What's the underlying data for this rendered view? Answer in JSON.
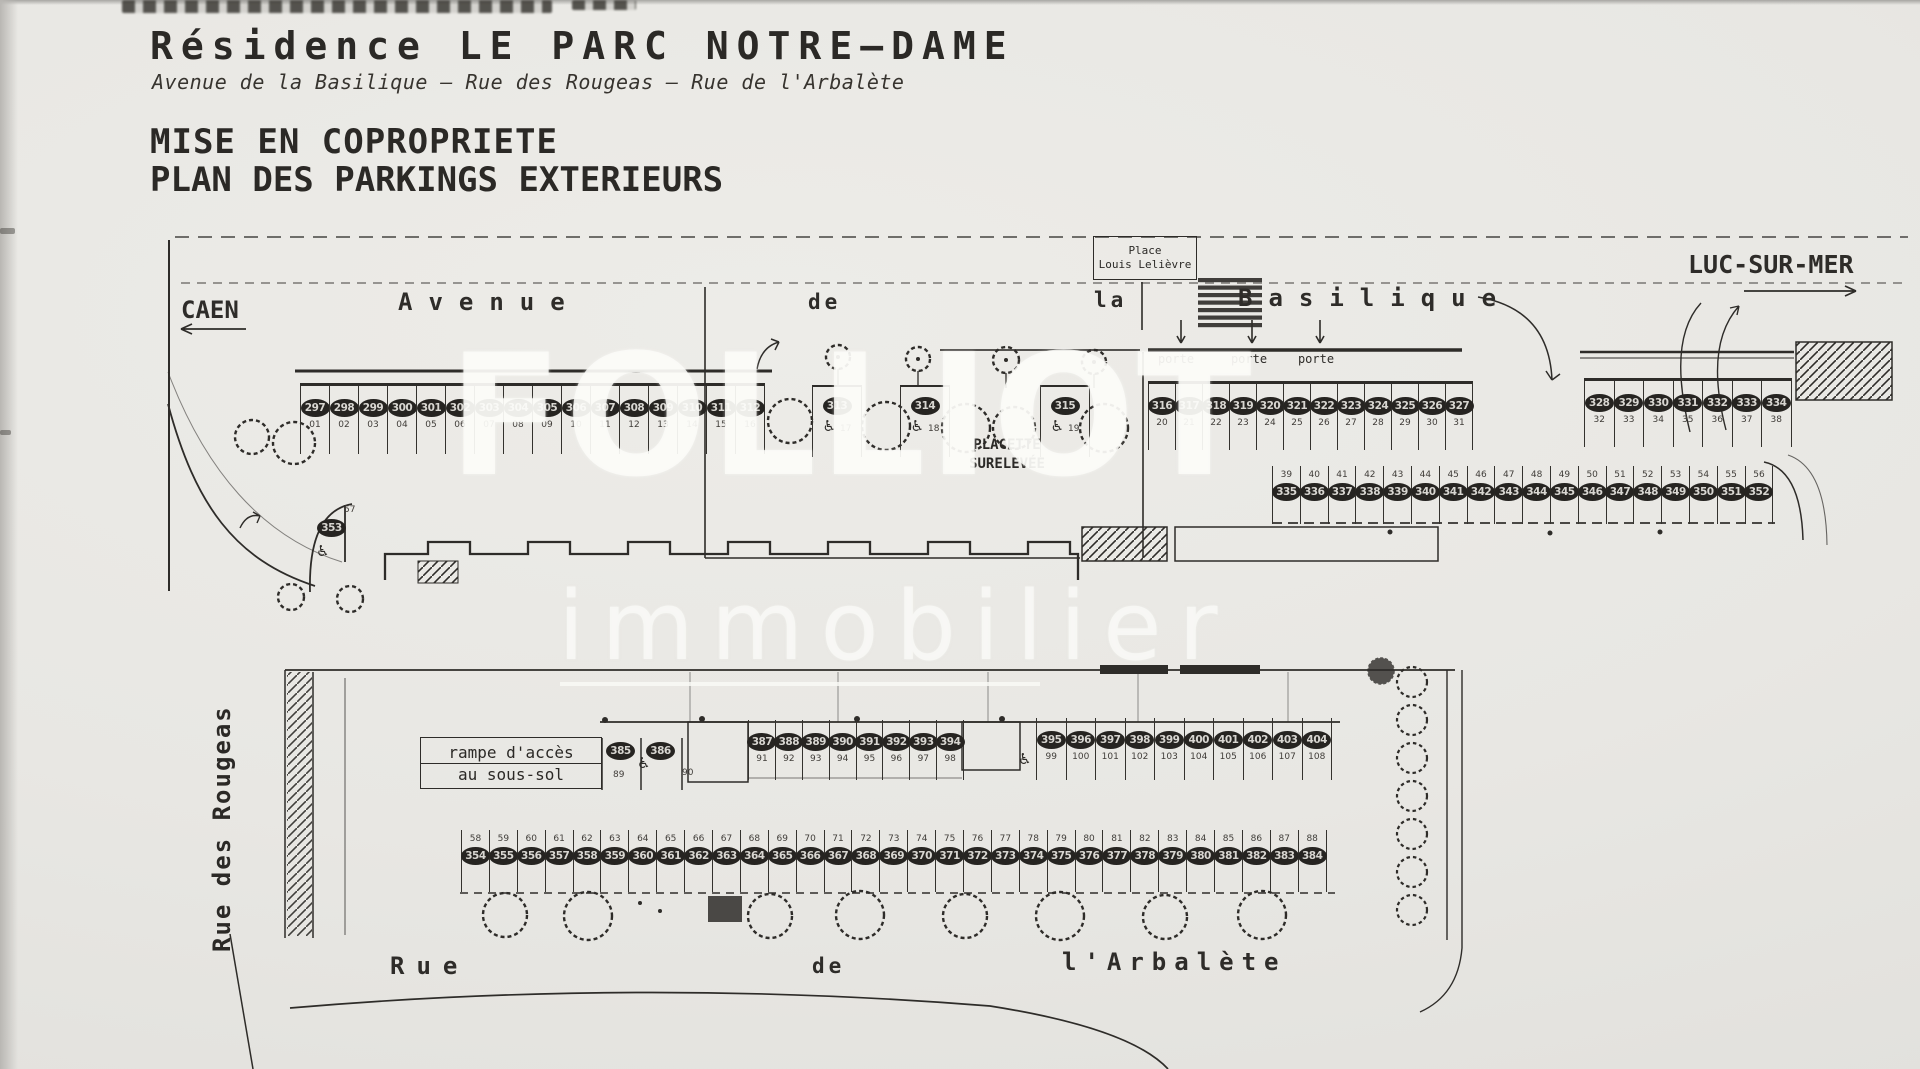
{
  "header": {
    "title": "Résidence LE PARC NOTRE–DAME",
    "subtitle": "Avenue de la Basilique – Rue des Rougeas – Rue de l'Arbalète",
    "heading_line1": "MISE EN COPROPRIETE",
    "heading_line2": "PLAN DES PARKINGS EXTERIEURS"
  },
  "watermark": {
    "line1": "FOLLIOT",
    "line2": "immobilier"
  },
  "symbols": {
    "wheelchair": "♿"
  },
  "colors": {
    "ink": "#2e2c29",
    "paper": "#e8e7e3",
    "watermark": "#fafaf7",
    "chip_fill": "#262421"
  },
  "upper": {
    "labels": {
      "caen": "CAEN",
      "luc_sur_mer": "LUC-SUR-MER",
      "avenue": "Avenue",
      "de": "de",
      "la": "la",
      "basilique": "Basilique",
      "place_line1": "Place",
      "place_line2": "Louis Lelièvre",
      "placette_line1": "PLACETTE",
      "placette_line2": "SURELEVÉE",
      "porte": "porte"
    },
    "row1_left": [
      {
        "n": "297",
        "s": "01"
      },
      {
        "n": "298",
        "s": "02"
      },
      {
        "n": "299",
        "s": "03"
      },
      {
        "n": "300",
        "s": "04"
      },
      {
        "n": "301",
        "s": "05"
      },
      {
        "n": "302",
        "s": "06"
      },
      {
        "n": "303",
        "s": "07"
      },
      {
        "n": "304",
        "s": "08"
      },
      {
        "n": "305",
        "s": "09"
      },
      {
        "n": "306",
        "s": "10"
      },
      {
        "n": "307",
        "s": "11"
      },
      {
        "n": "308",
        "s": "12"
      },
      {
        "n": "309",
        "s": "13"
      },
      {
        "n": "310",
        "s": "14"
      },
      {
        "n": "311",
        "s": "15"
      },
      {
        "n": "312",
        "s": "16"
      }
    ],
    "mid": [
      {
        "n": "313",
        "s": "17"
      },
      {
        "n": "314",
        "s": "18"
      },
      {
        "n": "315",
        "s": "19"
      }
    ],
    "row1_right": [
      {
        "n": "316",
        "s": "20"
      },
      {
        "n": "317",
        "s": "21"
      },
      {
        "n": "318",
        "s": "22"
      },
      {
        "n": "319",
        "s": "23"
      },
      {
        "n": "320",
        "s": "24"
      },
      {
        "n": "321",
        "s": "25"
      },
      {
        "n": "322",
        "s": "26"
      },
      {
        "n": "323",
        "s": "27"
      },
      {
        "n": "324",
        "s": "28"
      },
      {
        "n": "325",
        "s": "29"
      },
      {
        "n": "326",
        "s": "30"
      },
      {
        "n": "327",
        "s": "31"
      }
    ],
    "row1_far": [
      {
        "n": "328",
        "s": "32"
      },
      {
        "n": "329",
        "s": "33"
      },
      {
        "n": "330",
        "s": "34"
      },
      {
        "n": "331",
        "s": "35"
      },
      {
        "n": "332",
        "s": "36"
      },
      {
        "n": "333",
        "s": "37"
      },
      {
        "n": "334",
        "s": "38"
      }
    ],
    "row2": [
      {
        "n": "335",
        "s": "39"
      },
      {
        "n": "336",
        "s": "40"
      },
      {
        "n": "337",
        "s": "41"
      },
      {
        "n": "338",
        "s": "42"
      },
      {
        "n": "339",
        "s": "43"
      },
      {
        "n": "340",
        "s": "44"
      },
      {
        "n": "341",
        "s": "45"
      },
      {
        "n": "342",
        "s": "46"
      },
      {
        "n": "343",
        "s": "47"
      },
      {
        "n": "344",
        "s": "48"
      },
      {
        "n": "345",
        "s": "49"
      },
      {
        "n": "346",
        "s": "50"
      },
      {
        "n": "347",
        "s": "51"
      },
      {
        "n": "348",
        "s": "52"
      },
      {
        "n": "349",
        "s": "53"
      },
      {
        "n": "350",
        "s": "54"
      },
      {
        "n": "351",
        "s": "55"
      },
      {
        "n": "352",
        "s": "56"
      }
    ],
    "s353": {
      "n": "353",
      "s": "57"
    }
  },
  "lower": {
    "labels": {
      "rue_des_rougeas": "Rue des Rougeas",
      "rampe_line1": "rampe d'accès",
      "rampe_line2": "au sous-sol",
      "rue": "Rue",
      "de": "de",
      "arbalete": "l'Arbalète"
    },
    "s385": {
      "n": "385",
      "s": "89"
    },
    "s386": {
      "n": "386",
      "s": "90"
    },
    "row1_mid": [
      {
        "n": "387",
        "s": "91"
      },
      {
        "n": "388",
        "s": "92"
      },
      {
        "n": "389",
        "s": "93"
      },
      {
        "n": "390",
        "s": "94"
      },
      {
        "n": "391",
        "s": "95"
      },
      {
        "n": "392",
        "s": "96"
      },
      {
        "n": "393",
        "s": "97"
      },
      {
        "n": "394",
        "s": "98"
      }
    ],
    "row1_right": [
      {
        "n": "395",
        "s": "99"
      },
      {
        "n": "396",
        "s": "100"
      },
      {
        "n": "397",
        "s": "101"
      },
      {
        "n": "398",
        "s": "102"
      },
      {
        "n": "399",
        "s": "103"
      },
      {
        "n": "400",
        "s": "104"
      },
      {
        "n": "401",
        "s": "105"
      },
      {
        "n": "402",
        "s": "106"
      },
      {
        "n": "403",
        "s": "107"
      },
      {
        "n": "404",
        "s": "108"
      }
    ],
    "row2": [
      {
        "n": "354",
        "s": "58"
      },
      {
        "n": "355",
        "s": "59"
      },
      {
        "n": "356",
        "s": "60"
      },
      {
        "n": "357",
        "s": "61"
      },
      {
        "n": "358",
        "s": "62"
      },
      {
        "n": "359",
        "s": "63"
      },
      {
        "n": "360",
        "s": "64"
      },
      {
        "n": "361",
        "s": "65"
      },
      {
        "n": "362",
        "s": "66"
      },
      {
        "n": "363",
        "s": "67"
      },
      {
        "n": "364",
        "s": "68"
      },
      {
        "n": "365",
        "s": "69"
      },
      {
        "n": "366",
        "s": "70"
      },
      {
        "n": "367",
        "s": "71"
      },
      {
        "n": "368",
        "s": "72"
      },
      {
        "n": "369",
        "s": "73"
      },
      {
        "n": "370",
        "s": "74"
      },
      {
        "n": "371",
        "s": "75"
      },
      {
        "n": "372",
        "s": "76"
      },
      {
        "n": "373",
        "s": "77"
      },
      {
        "n": "374",
        "s": "78"
      },
      {
        "n": "375",
        "s": "79"
      },
      {
        "n": "376",
        "s": "80"
      },
      {
        "n": "377",
        "s": "81"
      },
      {
        "n": "378",
        "s": "82"
      },
      {
        "n": "379",
        "s": "83"
      },
      {
        "n": "380",
        "s": "84"
      },
      {
        "n": "381",
        "s": "85"
      },
      {
        "n": "382",
        "s": "86"
      },
      {
        "n": "383",
        "s": "87"
      },
      {
        "n": "384",
        "s": "88"
      }
    ]
  }
}
